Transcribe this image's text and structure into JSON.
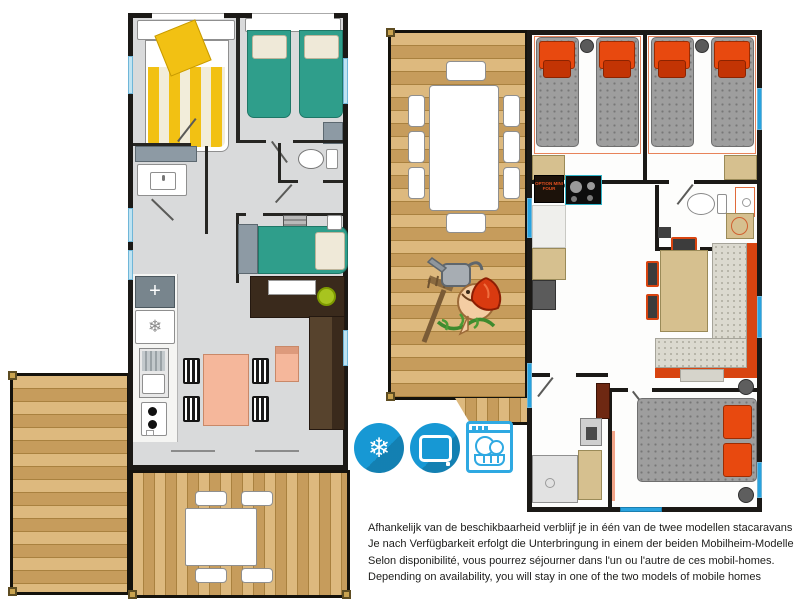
{
  "caption": {
    "lines": [
      "Afhankelijk van de beschikbaarheid verblijf je in één van de twee modellen stacaravans",
      "Je nach Verfügbarkeit erfolgt die Unterbringung in einem der beiden Mobilheim-Modelle",
      "Selon disponibilité, vous pourrez séjourner dans l'un ou l'autre de ces mobil-homes.",
      "Depending on availability, you will stay in one of the two models of mobile homes"
    ]
  },
  "right_plan": {
    "kitchen_option_label": "OPTION MINI FOUR"
  },
  "glyphs": {
    "snowflake": "❄",
    "fridge_snowflake": "❄",
    "hob_cross": "+"
  },
  "amenities": [
    {
      "name": "air-conditioning",
      "icon": "snowflake-icon"
    },
    {
      "name": "television",
      "icon": "tv-icon"
    },
    {
      "name": "dishwasher",
      "icon": "dishwasher-icon"
    }
  ],
  "colors": {
    "wall": "#1b1916",
    "floor_gray": "#d9dadb",
    "wood_a": "#ddb97e",
    "wood_b": "#c69c5c",
    "bed_yellow": "#f2c113",
    "bed_green": "#2f9e8b",
    "mattress_gray": "#9e9e9e",
    "pillow_orange": "#e8490f",
    "pillow_red": "#c33404",
    "salmon": "#f5b79b",
    "brown_dark": "#3a2a1c",
    "tan": "#d6c08f",
    "sofa_orange": "#d84410",
    "window_blue": "#29a3df",
    "icon_blue": "#1798d4",
    "icon_outline": "#2fa9e2",
    "gray_cab": "#8d9aa4",
    "stool_green": "#a8c41f",
    "text": "#1d1d1b"
  }
}
